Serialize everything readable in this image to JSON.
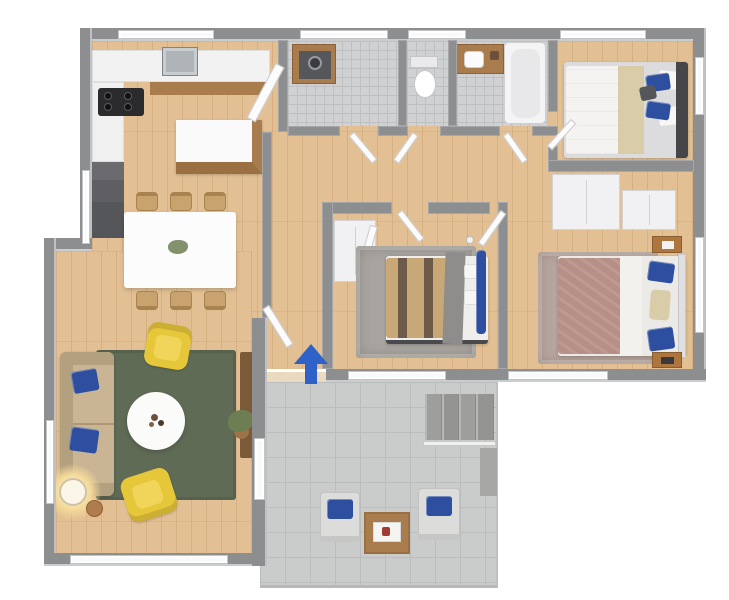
{
  "scene": {
    "type": "3d-floor-plan-rendering",
    "view": "isometric top-down apartment floor plan, no text labels",
    "background": "#ffffff",
    "entrance_marker": {
      "shape": "arrow-up",
      "meaning": "main entrance",
      "color": "#2e62c8"
    },
    "rooms": [
      {
        "name": "kitchen",
        "floor": "light wood",
        "furniture": [
          "l-shaped white counter",
          "metal sink",
          "black cooktop with 4 burners",
          "dark oven-fridge column",
          "kitchen island with white top and wood base"
        ]
      },
      {
        "name": "dining-area",
        "floor": "light wood",
        "furniture": [
          "white rectangular dining table",
          "6 light wood chairs",
          "small plant centerpiece"
        ]
      },
      {
        "name": "living-room",
        "floor": "light wood",
        "furniture": [
          "beige sofa with 2 blue pillows",
          "dark green rug",
          "round white coffee table",
          "2 yellow armchairs",
          "glowing floor lamp",
          "small round side table",
          "dark wood tv console",
          "potted plant"
        ]
      },
      {
        "name": "utility-room",
        "floor": "small gray tile",
        "furniture": [
          "washing machine with wood surround"
        ]
      },
      {
        "name": "wc",
        "floor": "small gray tile",
        "furniture": [
          "toilet"
        ]
      },
      {
        "name": "bathroom",
        "floor": "small gray tile",
        "furniture": [
          "wood vanity with white sink",
          "bathtub"
        ]
      },
      {
        "name": "bedroom-top-right",
        "floor": "light wood",
        "furniture": [
          "double bed with white duvet, beige throw, blue + white pillows, dark headboard on right"
        ]
      },
      {
        "name": "bedroom-middle",
        "floor": "light wood",
        "furniture": [
          "double bed with tan striped duvet and gray blanket",
          "gray shag rug",
          "white wardrobe with open door",
          "pendant lamp"
        ]
      },
      {
        "name": "bedroom-bottom-right",
        "floor": "light wood",
        "furniture": [
          "double bed with mauve duvet, white blanket, blue pillows",
          "mauve shag rug",
          "2 white wardrobes",
          "2 wood nightstands"
        ]
      },
      {
        "name": "patio",
        "floor": "large gray tile, open air",
        "furniture": [
          "2 gray outdoor chairs with blue cushions",
          "wood coffee table with white tray",
          "4 entry steps with white railing"
        ]
      }
    ]
  },
  "colors": {
    "wall": "#8d8e90",
    "wood": "#e2c094",
    "tile": "#d0d1d3",
    "tileLine": "#bfc0c2",
    "patioTile": "#cacccb",
    "patioLine": "#bcbebd",
    "rugGreen": "#5f6b55",
    "rugGray": "#a8a49f",
    "rugMauve": "#b7a69f",
    "sofa": "#c9b493",
    "sofaBack": "#b3a07f",
    "pillowBlue": "#2e4f9f",
    "chairYellow": "#e7c73a",
    "counterWood": "#a87c4c",
    "applianceDark": "#55565a",
    "duvetTan": "#c9a877",
    "stripeBrown": "#6e5a48",
    "duvetMauve": "#b78f87",
    "throwBeige": "#d9cca9",
    "headboardDark": "#46464a",
    "nightstandWood": "#ad763f",
    "arrowBlue": "#2e62c8",
    "plantGreen": "#6d7f52",
    "consoleBrown": "#7b5a3a",
    "chairWood": "#c8a36e",
    "lampGlow": "#f3d998"
  }
}
